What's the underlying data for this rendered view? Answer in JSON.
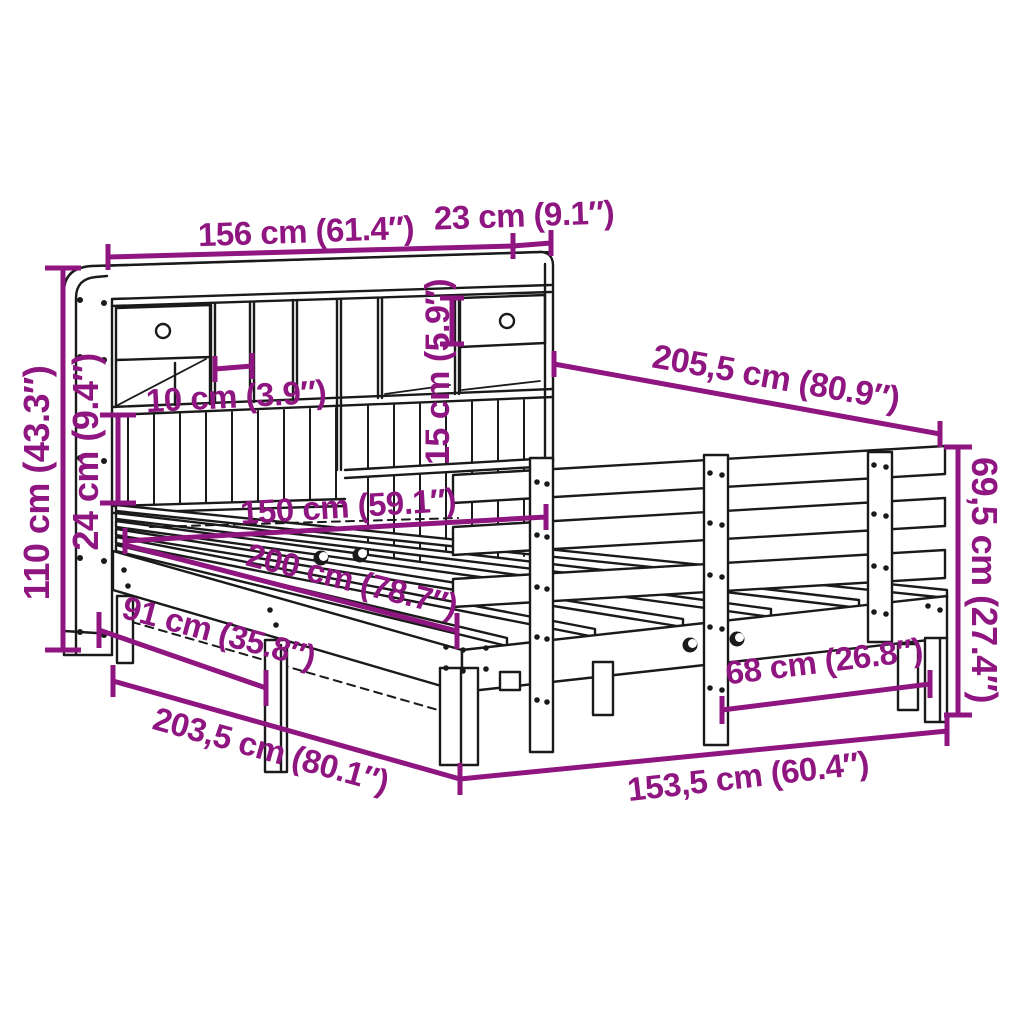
{
  "diagram": {
    "kind": "product-dimension-diagram",
    "subject": "bookcase-bed-with-side-rail"
  },
  "colors": {
    "accent": "#8F1581",
    "line": "#1a1a1a",
    "background": "#ffffff"
  },
  "dims": {
    "headboard_width": {
      "label": "156 cm (61.4″)"
    },
    "headboard_depth": {
      "label": "23 cm (9.1″)"
    },
    "headboard_height": {
      "label": "110 cm (43.3″)"
    },
    "shelf_section": {
      "label": "24 cm (9.4″)"
    },
    "cubby_width": {
      "label": "10 cm (3.9″)"
    },
    "drawer_height": {
      "label": "15 cm (5.9″)"
    },
    "total_length": {
      "label": "205,5 cm (80.9″)"
    },
    "mattress_width": {
      "label": "150 cm (59.1″)"
    },
    "mattress_length": {
      "label": "200 cm (78.7″)"
    },
    "underbed": {
      "label": "91 cm (35.8″)"
    },
    "frame_length": {
      "label": "203,5 cm (80.1″)"
    },
    "leg_spacing": {
      "label": "68 cm (26.8″)"
    },
    "frame_width": {
      "label": "153,5 cm (60.4″)"
    },
    "rail_height": {
      "label": "69,5 cm (27.4″)"
    }
  }
}
